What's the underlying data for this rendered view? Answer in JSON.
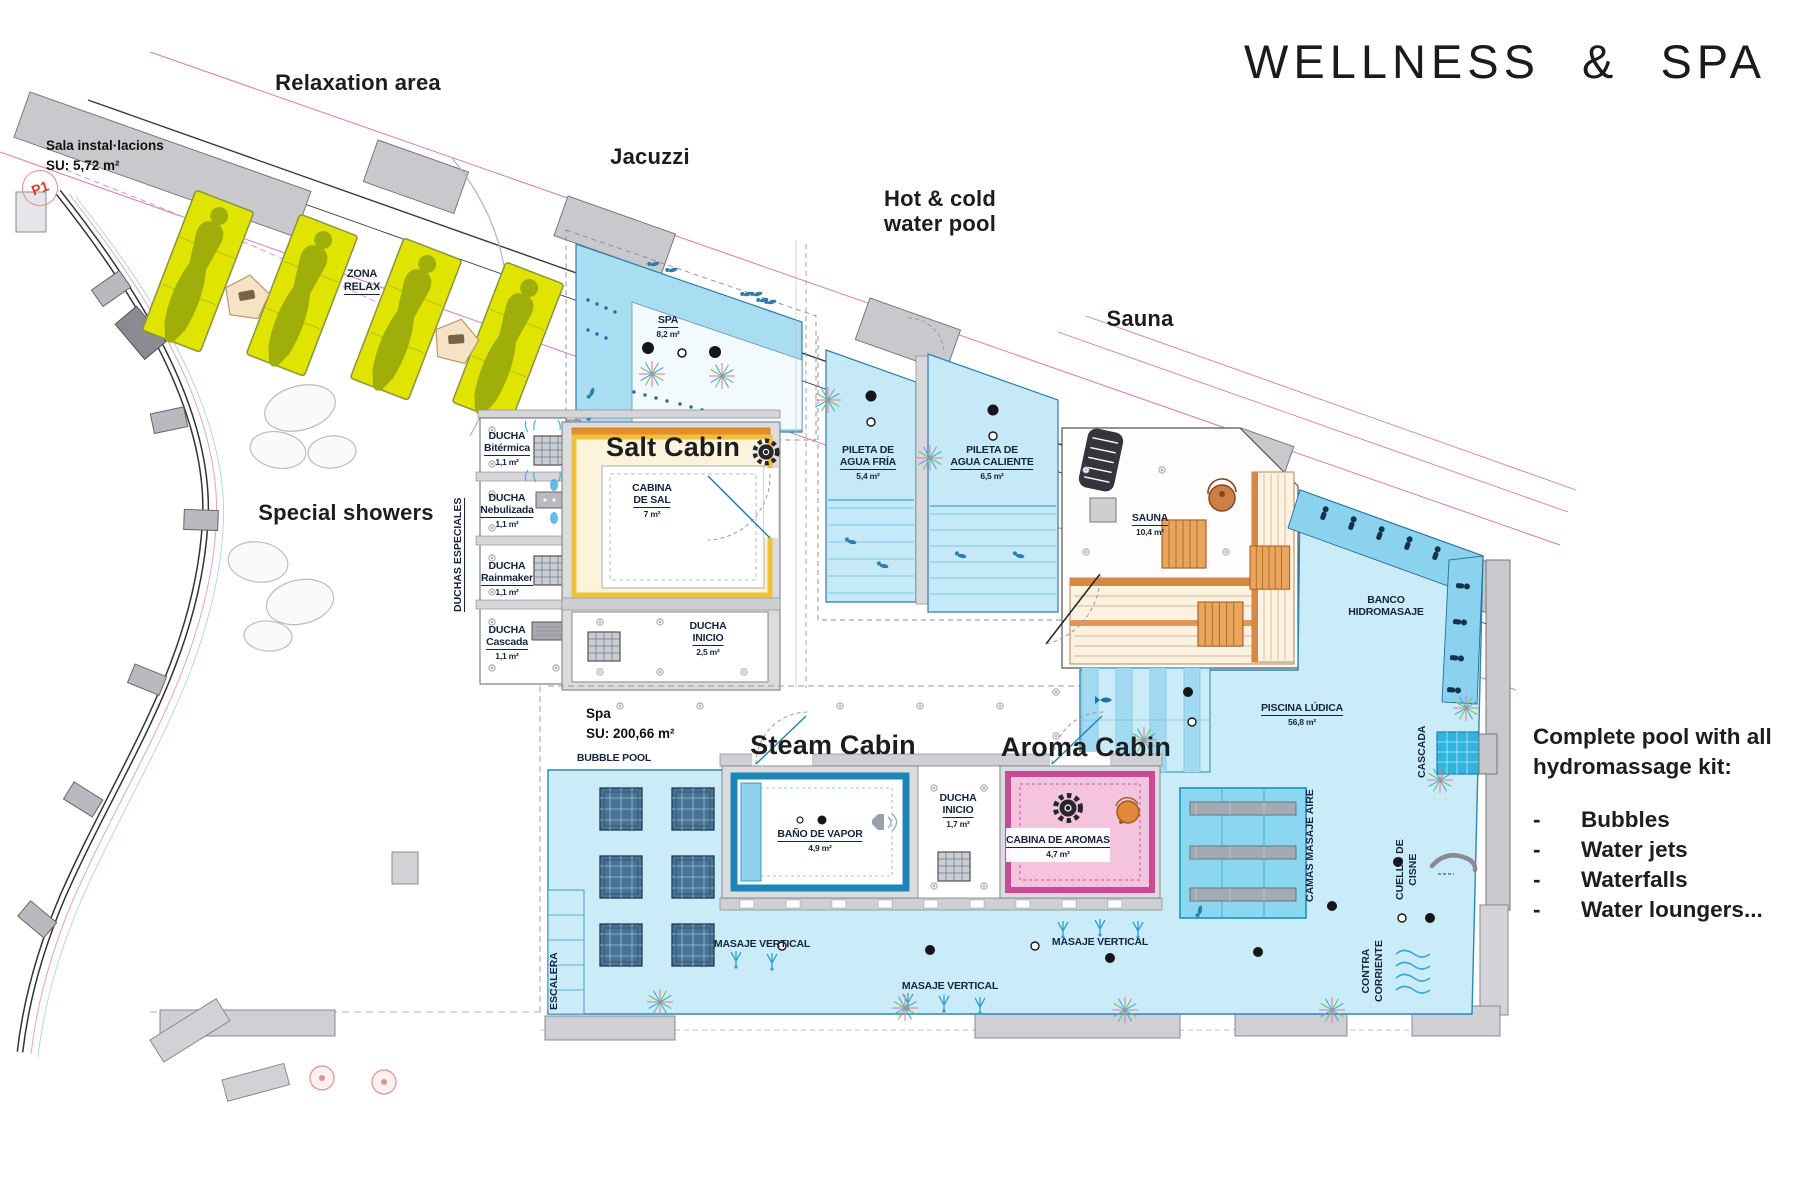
{
  "title": "WELLNESS & SPA",
  "annotations": {
    "relaxation_area": "Relaxation area",
    "jacuzzi": "Jacuzzi",
    "hot_cold_1": "Hot & cold",
    "hot_cold_2": "water pool",
    "sauna": "Sauna",
    "salt_cabin": "Salt Cabin",
    "special_showers": "Special showers",
    "steam_cabin": "Steam Cabin",
    "aroma_cabin": "Aroma Cabin"
  },
  "callout": {
    "line1": "Complete pool with all",
    "line2": "hydromassage kit:",
    "dash": "-",
    "items": [
      "Bubbles",
      "Water jets",
      "Waterfalls",
      "Water loungers..."
    ]
  },
  "rooms": {
    "sala": {
      "name": "Sala instal·lacions",
      "area": "SU: 5,72 m²"
    },
    "p1": "P1",
    "zona_relax": {
      "l1": "ZONA",
      "l2": "RELAX"
    },
    "spa_tub": {
      "name": "SPA",
      "area": "8,2 m²"
    },
    "duchas_especiales": "DUCHAS ESPECIALES",
    "ducha_bitermica": {
      "l1": "DUCHA",
      "l2": "Bitérmica",
      "area": "1,1 m²"
    },
    "ducha_nebulizada": {
      "l1": "DUCHA",
      "l2": "Nebulizada",
      "area": "1,1 m²"
    },
    "ducha_rainmaker": {
      "l1": "DUCHA",
      "l2": "Rainmaker",
      "area": "1,1 m²"
    },
    "ducha_cascada": {
      "l1": "DUCHA",
      "l2": "Cascada",
      "area": "1,1 m²"
    },
    "cabina_sal": {
      "l1": "CABINA",
      "l2": "DE SAL",
      "area": "7 m²"
    },
    "ducha_inicio_salt": {
      "l1": "DUCHA",
      "l2": "INICIO",
      "area": "2,5 m²"
    },
    "pileta_fria": {
      "l1": "PILETA DE",
      "l2": "AGUA FRÍA",
      "area": "5,4 m²"
    },
    "pileta_caliente": {
      "l1": "PILETA DE",
      "l2": "AGUA CALIENTE",
      "area": "6,5 m²"
    },
    "sauna_room": {
      "name": "SAUNA",
      "area": "10,4 m²"
    },
    "banco": {
      "l1": "BANCO",
      "l2": "HIDROMASAJE"
    },
    "piscina_ludica": {
      "name": "PISCINA LÚDICA",
      "area": "56,8 m²"
    },
    "cascada": "CASCADA",
    "spa_zone": {
      "name": "Spa",
      "area": "SU: 200,66 m²"
    },
    "bubble_pool": "BUBBLE POOL",
    "bano_vapor": {
      "name": "BAÑO DE VAPOR",
      "area": "4,9 m²"
    },
    "ducha_inicio_steam": {
      "l1": "DUCHA",
      "l2": "INICIO",
      "area": "1,7 m²"
    },
    "cabina_aromas": {
      "name": "CABINA DE AROMAS",
      "area": "4,7 m²"
    },
    "camas": "CAMAS MASAJE AIRE",
    "cuello": {
      "l1": "CUELLO DE",
      "l2": "CISNE"
    },
    "contra": {
      "l1": "CONTRA",
      "l2": "CORRIENTE"
    },
    "masaje_vertical": "MASAJE VERTICAL",
    "escalera": "ESCALERA"
  },
  "colors": {
    "pool_blue": "#c9ecf8",
    "deep_pool_blue": "#8bd6f1",
    "lounger_yellow": "#dfe500",
    "sauna_wood": "#d9883f",
    "salt_yellow": "#f0c23c",
    "aroma_pink": "#d04a98",
    "steam_blue": "#1b86b8",
    "wall_gray": "#cfcfd4",
    "dimension_magenta": "#d978b8",
    "p1_red": "#e03828"
  }
}
